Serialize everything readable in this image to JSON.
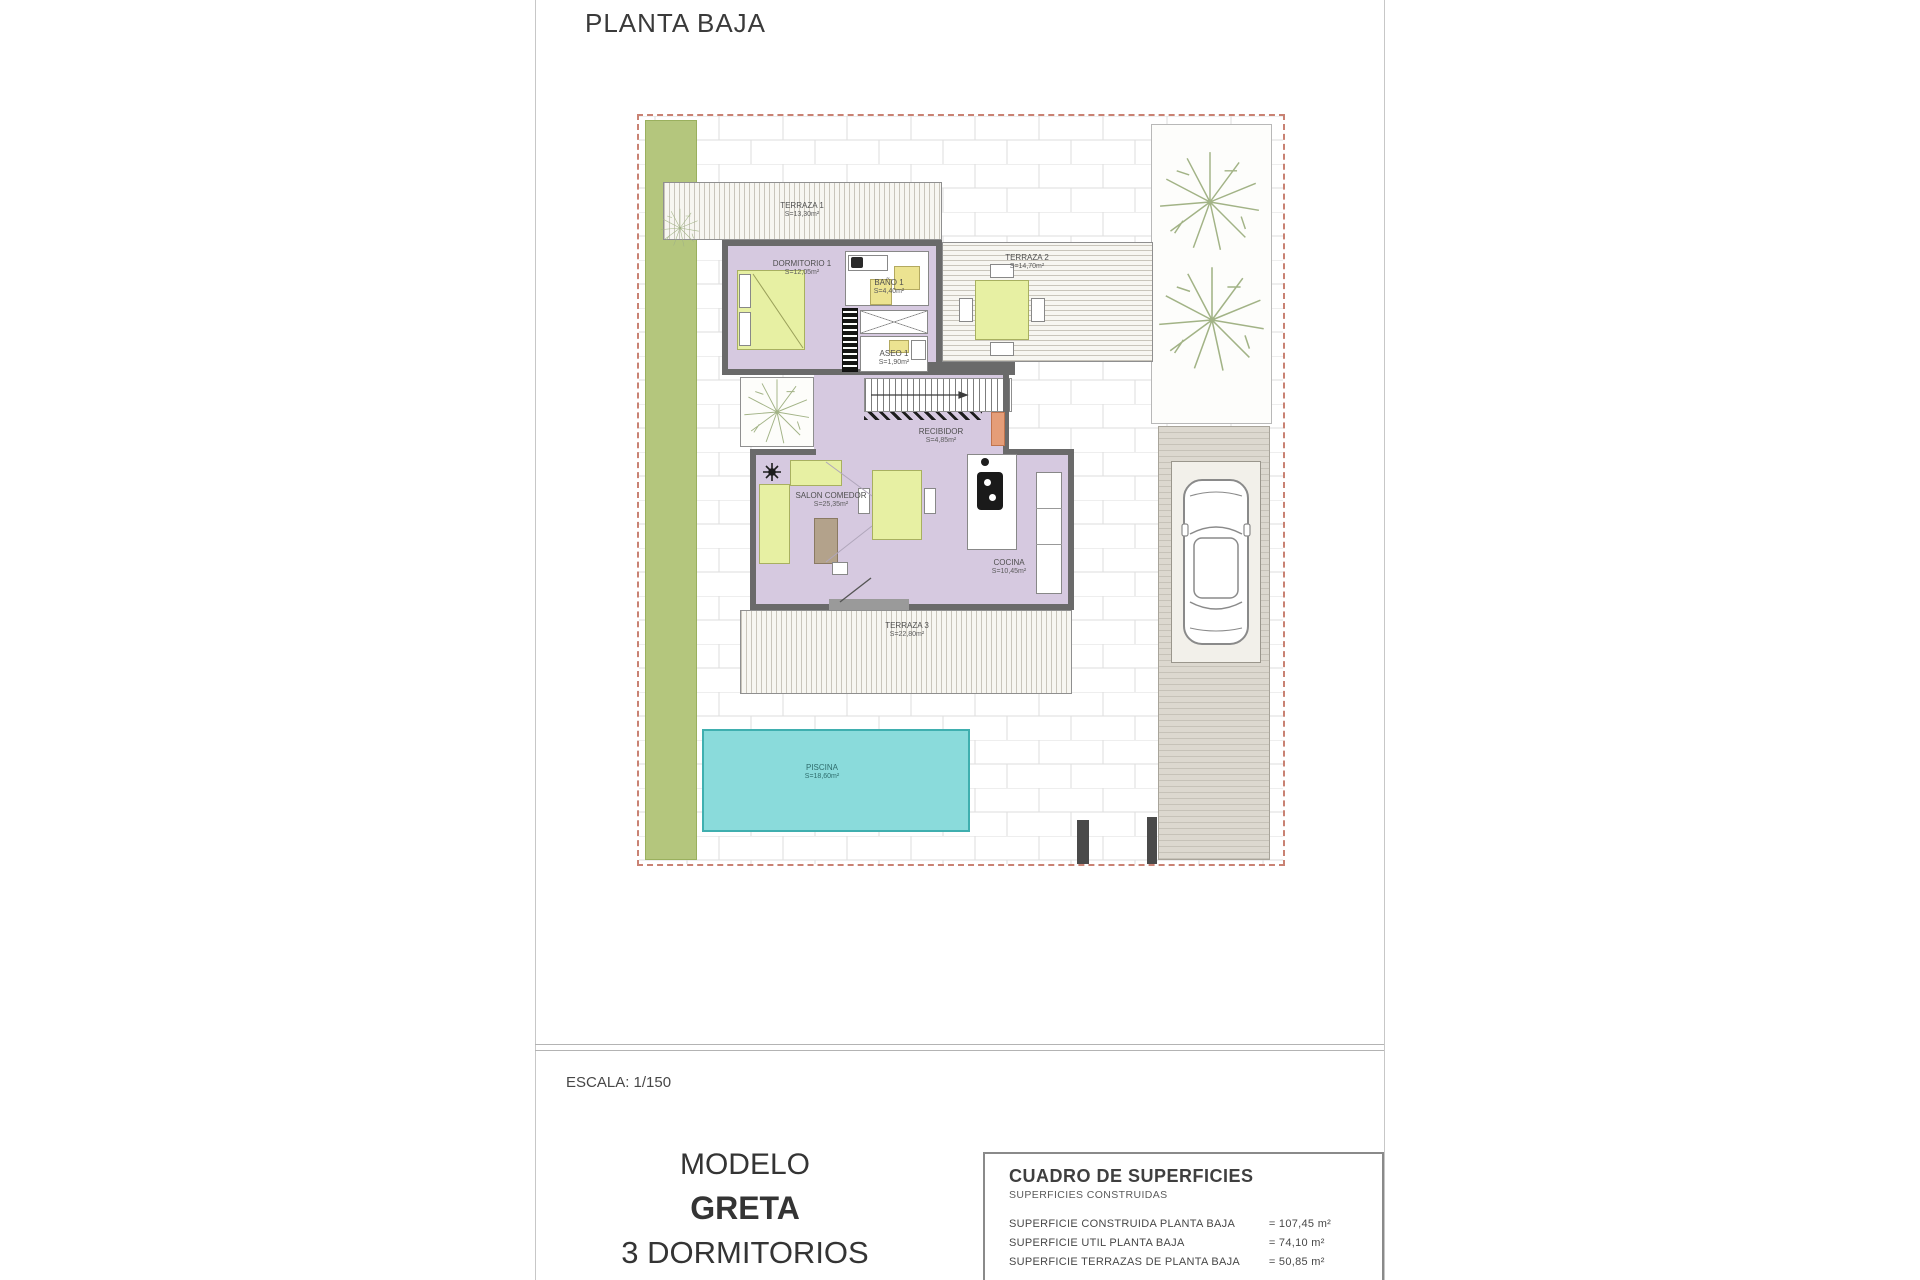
{
  "page": {
    "title": "PLANTA BAJA",
    "scale_label": "ESCALA: 1/150"
  },
  "model_block": {
    "line1": "MODELO",
    "line2": "GRETA",
    "line3": "3 DORMITORIOS"
  },
  "surfaces_table": {
    "title": "CUADRO DE SUPERFICIES",
    "subtitle": "SUPERFICIES CONSTRUIDAS",
    "rows": [
      {
        "label": "SUPERFICIE CONSTRUIDA PLANTA BAJA",
        "value": "= 107,45 m²"
      },
      {
        "label": "SUPERFICIE UTIL PLANTA BAJA",
        "value": "= 74,10 m²"
      },
      {
        "label": "SUPERFICIE TERRAZAS DE PLANTA BAJA",
        "value": "= 50,85 m²"
      }
    ]
  },
  "rooms": {
    "terraza1": {
      "name": "TERRAZA 1",
      "area": "S=13,30m²"
    },
    "dormitorio1": {
      "name": "DORMITORIO 1",
      "area": "S=12,05m²"
    },
    "bano1": {
      "name": "BAÑO 1",
      "area": "S=4,40m²"
    },
    "terraza2": {
      "name": "TERRAZA 2",
      "area": "S=14,70m²"
    },
    "aseo1": {
      "name": "ASEO 1",
      "area": "S=1,90m²"
    },
    "recibidor": {
      "name": "RECIBIDOR",
      "area": "S=4,85m²"
    },
    "salon": {
      "name": "SALON COMEDOR",
      "area": "S=25,35m²"
    },
    "cocina": {
      "name": "COCINA",
      "area": "S=10,45m²"
    },
    "terraza3": {
      "name": "TERRAZA 3",
      "area": "S=22,80m²"
    },
    "piscina": {
      "name": "PISCINA",
      "area": "S=18,60m²"
    }
  },
  "colors": {
    "interior_lavender": "#d6c9e0",
    "wall_gray": "#6a6a6a",
    "garden_green": "#b4c67d",
    "pool_cyan": "#8adbdb",
    "furniture_yellow": "#e7f0a3",
    "boundary_dash": "#c98273",
    "driveway_beige": "#dcd8cf"
  }
}
